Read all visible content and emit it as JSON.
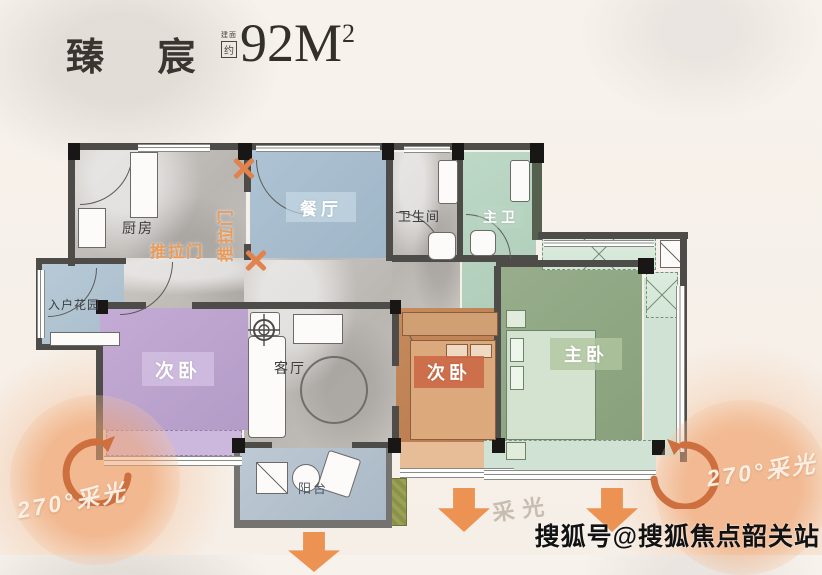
{
  "header": {
    "title": "臻 宸",
    "area_note_line1": "建面",
    "area_note_line2": "约",
    "area_value": "92M",
    "area_sup": "2"
  },
  "rooms": {
    "kitchen": "厨房",
    "dining": "餐厅",
    "bathroom": "卫生间",
    "master_bath": "主卫",
    "entry_garden": "入户花园",
    "bedroom_left": "次卧",
    "living": "客厅",
    "bedroom_mid": "次卧",
    "master_bedroom": "主卧",
    "balcony": "阳台"
  },
  "annotations": {
    "sliding_door": "推拉门",
    "sliding_door_vertical": "推拉门",
    "daylight": "采光",
    "daylight_270_left": "270°采光",
    "daylight_270_right": "270°采光"
  },
  "watermark": "搜狐号@搜狐焦点韶关站",
  "colors": {
    "accent_orange": "#EC9354",
    "curve_arrow_orange": "#CD6F3F",
    "wall_gray": "#4E4C49",
    "dining_blue": "#A6BCCD",
    "garden_blue": "#B2C4D2",
    "balcony_blue": "#B5C2CE",
    "bedroom_purple": "#BEA6D0",
    "bedroom_orange": "#C18154",
    "master_green": "#91A886",
    "bath_green": "#B6D2C0",
    "closet_green": "#D3E6D6"
  }
}
